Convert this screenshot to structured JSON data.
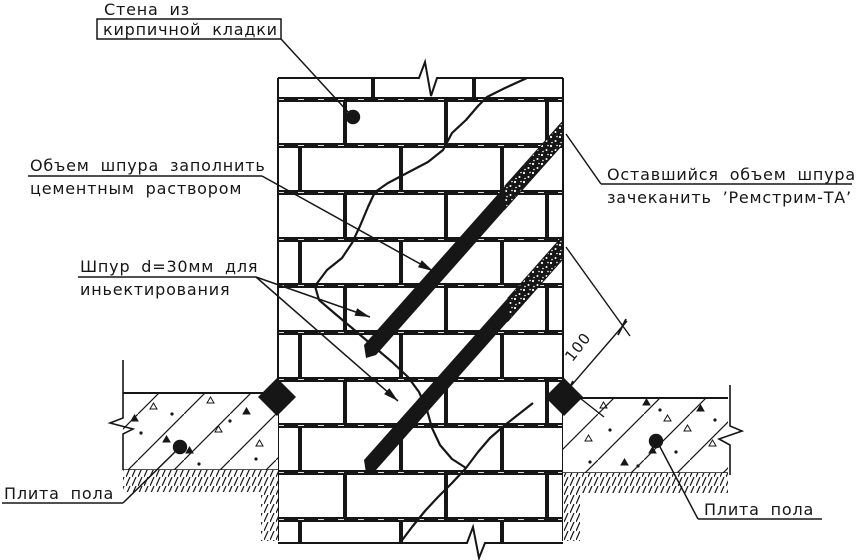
{
  "drawing": {
    "labels": {
      "wall": {
        "line1": "Стена из",
        "line2": "кирпичной кладки"
      },
      "fill": {
        "line1": "Объем шпура заполнить",
        "line2": "цементным раствором"
      },
      "borehole": {
        "line1": "Шпур d=30мм для",
        "line2": "иньектирования"
      },
      "caulk": {
        "line1": "Оставшийся объем шпура",
        "line2": "зачеканить ’Ремстрим-ТА’"
      },
      "floor_left": "Плита пола",
      "floor_right": "Плита пола"
    },
    "dimension": {
      "value": "100"
    },
    "colors": {
      "ink": "#161616",
      "paper": "#ffffff"
    }
  }
}
